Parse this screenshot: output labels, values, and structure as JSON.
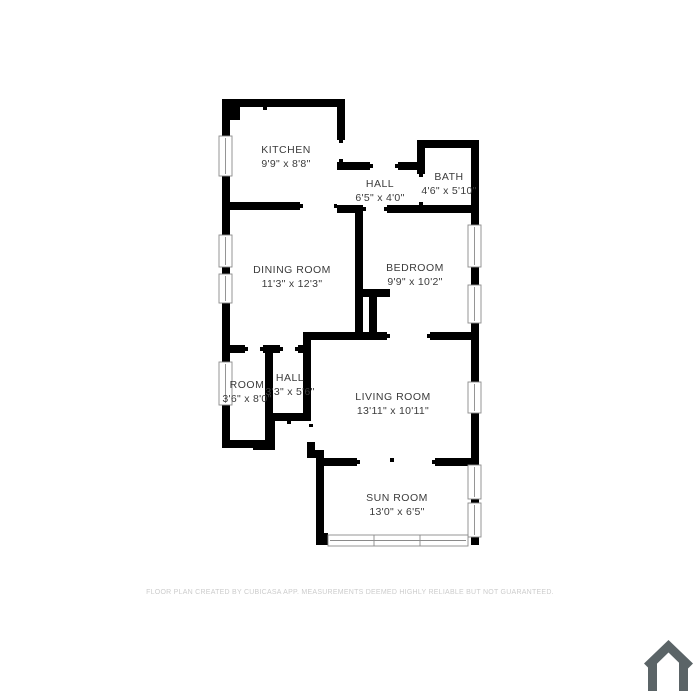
{
  "page": {
    "background_color": "#ffffff"
  },
  "floor_plan": {
    "wall_color": "#000000",
    "label_color": "#3b3b3b",
    "window_frame_color": "#8a8a8a",
    "rooms": [
      {
        "id": "kitchen",
        "name": "KITCHEN",
        "dims": "9'9\" x 8'8\""
      },
      {
        "id": "hall-upper",
        "name": "HALL",
        "dims": "6'5\" x 4'0\""
      },
      {
        "id": "bath",
        "name": "BATH",
        "dims": "4'6\" x 5'10\""
      },
      {
        "id": "dining-room",
        "name": "DINING ROOM",
        "dims": "11'3\" x 12'3\""
      },
      {
        "id": "bedroom",
        "name": "BEDROOM",
        "dims": "9'9\" x 10'2\""
      },
      {
        "id": "room",
        "name": "ROOM",
        "dims": "3'6\" x 8'0\""
      },
      {
        "id": "hall-lower",
        "name": "HALL",
        "dims": "3'3\" x 5'6\""
      },
      {
        "id": "living-room",
        "name": "LIVING ROOM",
        "dims": "13'11\" x 10'11\""
      },
      {
        "id": "sun-room",
        "name": "SUN ROOM",
        "dims": "13'0\" x 6'5\""
      }
    ]
  },
  "footer": {
    "text": "FLOOR PLAN CREATED BY CUBICASA APP. MEASUREMENTS DEEMED HIGHLY RELIABLE BUT NOT GUARANTEED.",
    "color": "#cccccc"
  },
  "logo": {
    "icon": "house-icon",
    "color": "#5b6467"
  }
}
